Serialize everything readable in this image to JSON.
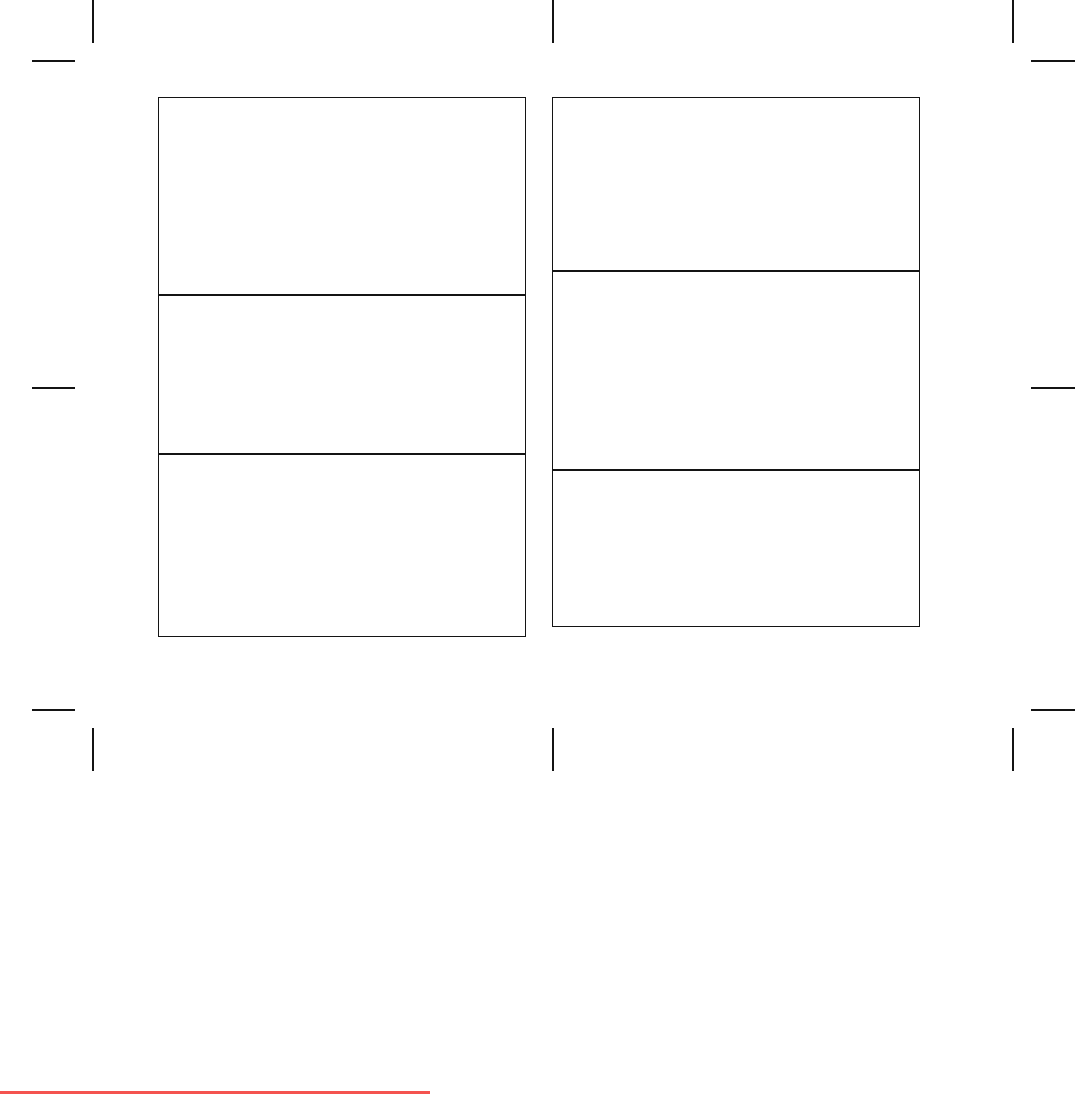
{
  "page": {
    "width": 1075,
    "height": 1095,
    "background": "#ffffff"
  },
  "colors": {
    "mark": "#141414",
    "panel_border": "#141414",
    "artifact_line": "#f4534f"
  },
  "crop_marks": [
    {
      "name": "trim-mark-top-vertical-left",
      "x": 92,
      "y": 0,
      "w": 2,
      "h": 43
    },
    {
      "name": "trim-mark-top-vertical-center",
      "x": 552,
      "y": 0,
      "w": 2,
      "h": 43
    },
    {
      "name": "trim-mark-top-vertical-right",
      "x": 1012,
      "y": 0,
      "w": 2,
      "h": 43
    },
    {
      "name": "trim-mark-top-horizontal-left",
      "x": 32,
      "y": 60,
      "w": 43,
      "h": 2
    },
    {
      "name": "trim-mark-top-horizontal-right",
      "x": 1031,
      "y": 60,
      "w": 44,
      "h": 2
    },
    {
      "name": "trim-mark-middle-horizontal-left",
      "x": 32,
      "y": 387,
      "w": 43,
      "h": 2
    },
    {
      "name": "trim-mark-middle-horizontal-right",
      "x": 1031,
      "y": 387,
      "w": 44,
      "h": 2
    },
    {
      "name": "trim-mark-bottom-horizontal-left",
      "x": 32,
      "y": 709,
      "w": 43,
      "h": 2
    },
    {
      "name": "trim-mark-bottom-horizontal-right",
      "x": 1031,
      "y": 709,
      "w": 44,
      "h": 2
    },
    {
      "name": "trim-mark-bottom-vertical-left",
      "x": 92,
      "y": 728,
      "w": 2,
      "h": 43
    },
    {
      "name": "trim-mark-bottom-vertical-center",
      "x": 552,
      "y": 728,
      "w": 2,
      "h": 43
    },
    {
      "name": "trim-mark-bottom-vertical-right",
      "x": 1012,
      "y": 728,
      "w": 2,
      "h": 43
    }
  ],
  "panels": [
    {
      "name": "left-panel-grid",
      "x": 158,
      "y": 97,
      "w": 368,
      "h": 540,
      "dividers": [
        196,
        355
      ]
    },
    {
      "name": "right-panel-grid",
      "x": 552,
      "y": 97,
      "w": 368,
      "h": 530,
      "dividers": [
        172,
        371
      ]
    }
  ],
  "artifact_line": {
    "name": "red-edge-line",
    "x": 0,
    "y": 1091,
    "w": 430,
    "h": 3
  }
}
